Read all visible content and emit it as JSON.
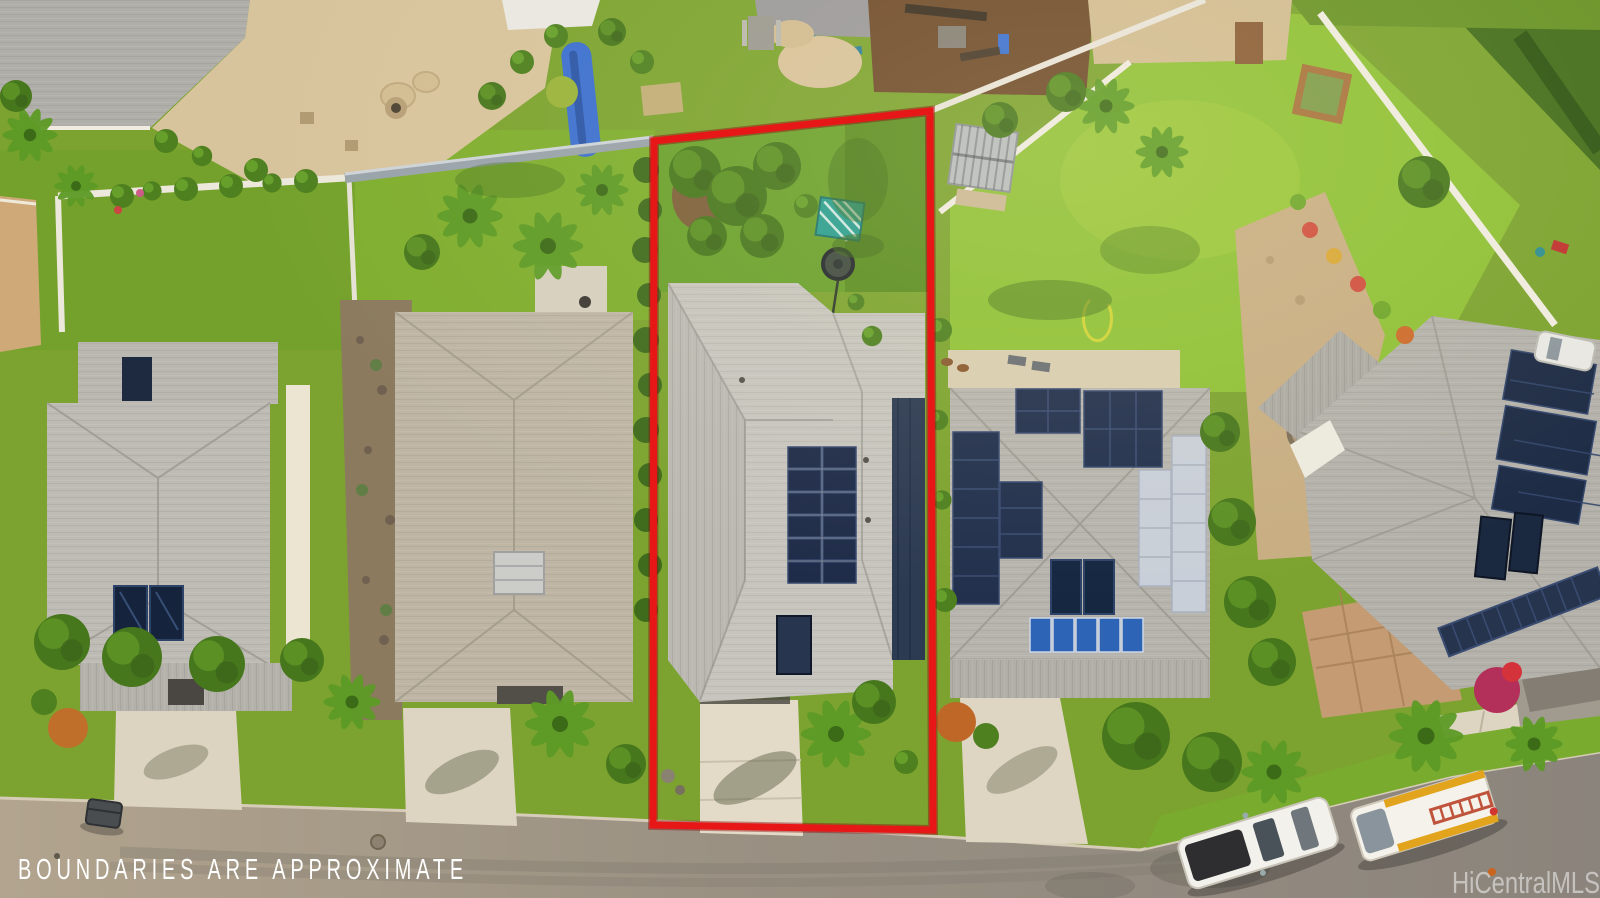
{
  "meta": {
    "kind": "aerial drone photograph of a residential neighborhood (real-estate listing photo)",
    "width_px": 1600,
    "height_px": 898
  },
  "overlays": {
    "disclaimer": "BOUNDARIES ARE APPROXIMATE",
    "watermark": "HiCentralMLS"
  },
  "annotation": {
    "boundary_color": "#e81717",
    "boundary_shape": "quadrilateral outline around subject lot",
    "boundary_corners_px": [
      [
        654,
        141
      ],
      [
        930,
        111
      ],
      [
        933,
        830
      ],
      [
        653,
        825
      ]
    ]
  },
  "palette": {
    "grass_sun": "#8fc136",
    "grass": "#7ca32f",
    "grass_shade": "#47741c",
    "sand": "#d8c49c",
    "road": "#9a9183",
    "roof_gray": "#bdbbb4",
    "roof_tan": "#beb5a4",
    "solar_dark": "#22304d",
    "solar_light": "#c9cfd8",
    "solar_blue": "#2e64b5",
    "canopy_teal": "#2a9d8f",
    "wall_white": "#ece8dc",
    "concrete": "#e0d8c5"
  },
  "visible_objects": {
    "subject_lot": "two-story gray roof house with 12-panel rooftop solar array, skylight, rear lawn with teal shade canopy and trampoline, concrete driveway",
    "neighbor_lots": "four neighboring gray/tan hip roofs, three with rooftop solar panels and solar water heaters, metal garden shed, gravel fire-pit path, backyard playground and fire pit",
    "street": "curved asphalt street along bottom with sidewalk, grass parkway and palm trees",
    "vehicles": [
      "white pickup truck parked on street",
      "white and yellow utility truck with ladder parked on street",
      "white car in upper right driveway"
    ],
    "street_items": [
      "gray trash bin at curb",
      "manhole cover",
      "small orange object on road"
    ]
  }
}
